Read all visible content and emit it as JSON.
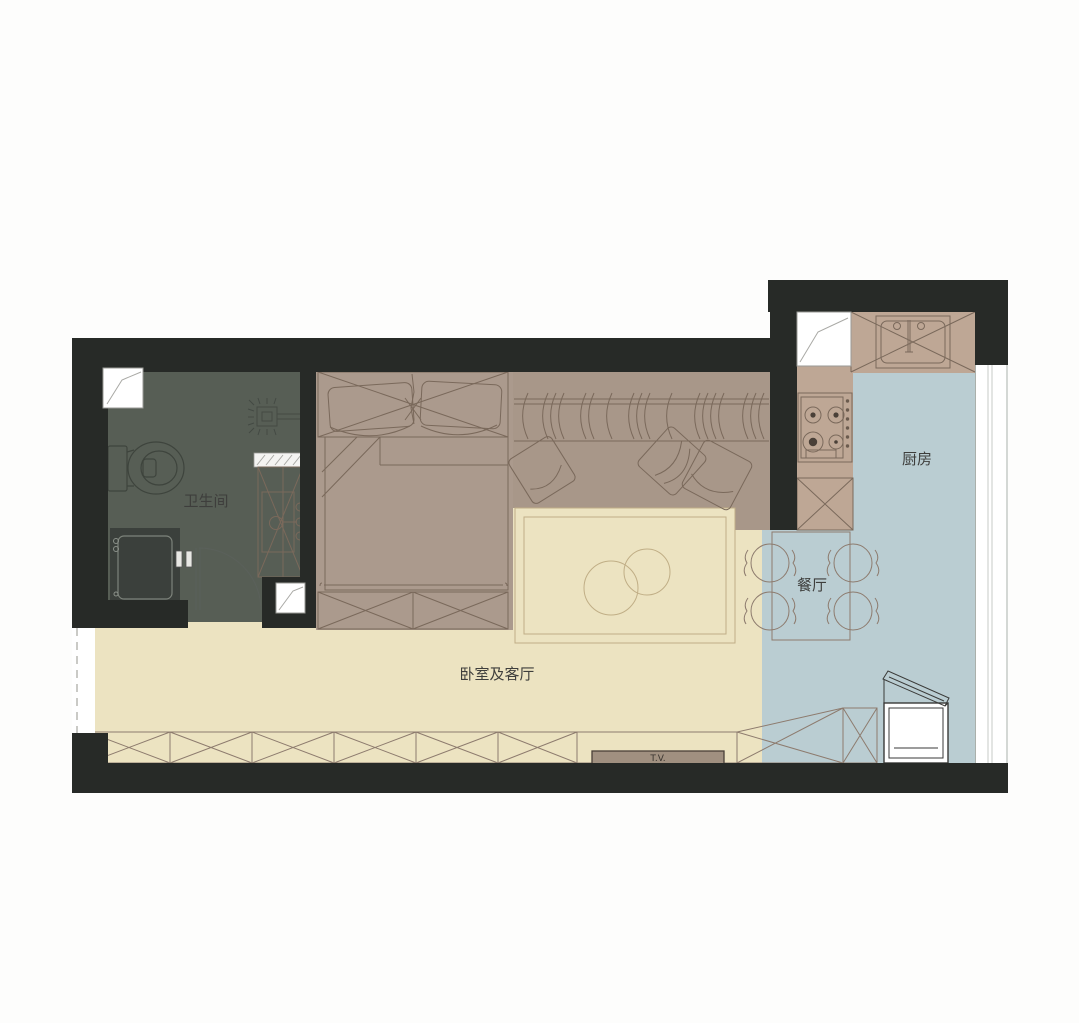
{
  "document": {
    "type": "apartment-floor-plan",
    "language": "zh-CN"
  },
  "palette": {
    "wall": "#272a27",
    "bathroom_floor": "#575e55",
    "bedroom_area": "#ab9a8d",
    "wardrobe_area": "#a89789",
    "living_floor": "#ece3c1",
    "rug": "#efe7c6",
    "kitchen_floor": "#bacdd2",
    "counter": "#bea795",
    "stove_top": "#c5afa0",
    "cabinet": "#b2a193",
    "dining_table": "#b29c8f",
    "shower": "#3b403c",
    "vanity": "#c2aa9b",
    "tv_fill": "#a09080",
    "label_color": "#3e3e3c",
    "white": "#ffffff"
  },
  "rooms": {
    "bathroom": {
      "label": "卫生间"
    },
    "bedroom_living": {
      "label": "卧室及客厅"
    },
    "kitchen": {
      "label": "厨房"
    },
    "dining": {
      "label": "餐厅"
    }
  },
  "appliances": {
    "tv": {
      "label": "T.V."
    }
  }
}
